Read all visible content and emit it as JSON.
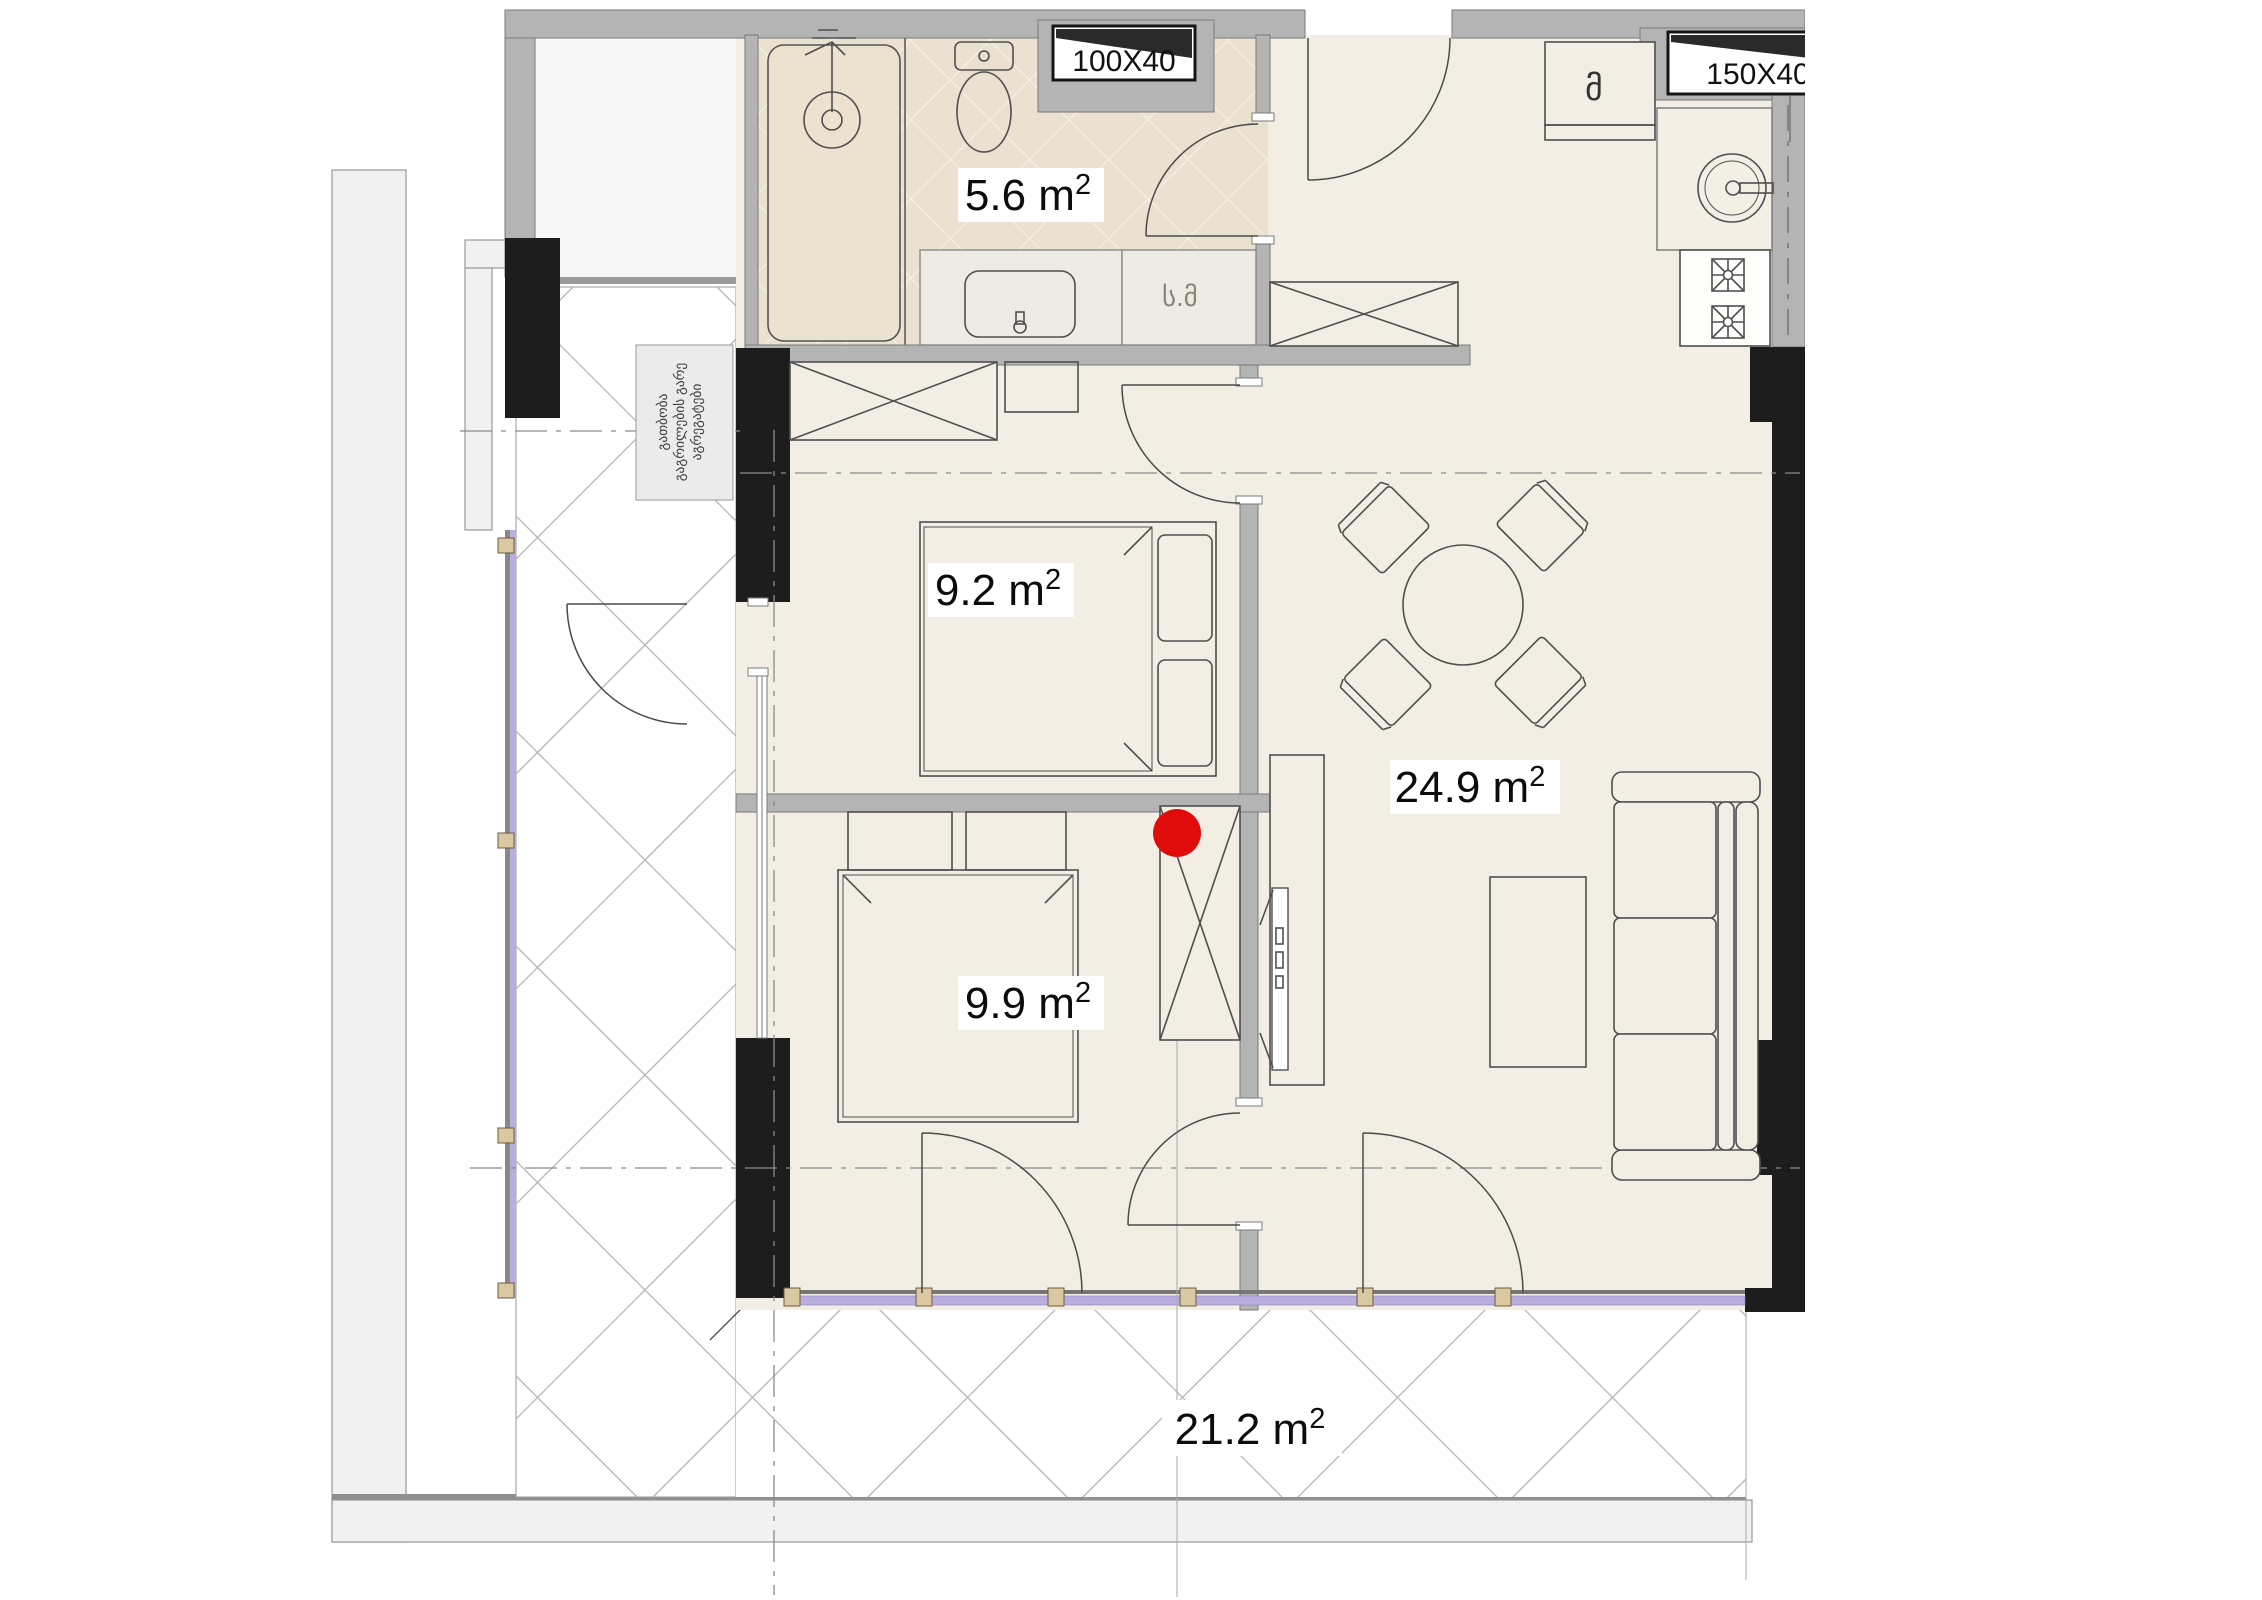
{
  "plan": {
    "rooms": {
      "bathroom": {
        "area": "5.6 m",
        "sup": "2"
      },
      "bedroom_top": {
        "area": "9.2 m",
        "sup": "2"
      },
      "bedroom_bottom": {
        "area": "9.9 m",
        "sup": "2"
      },
      "living_kitchen": {
        "area": "24.9 m",
        "sup": "2"
      },
      "terrace": {
        "area": "21.2 m",
        "sup": "2"
      }
    },
    "vents": {
      "small": "100X40",
      "large": "150X40"
    },
    "labels": {
      "washing_machine": "ს.მ",
      "fridge": "მ"
    },
    "note": {
      "lines": [
        "გათბობა",
        "გაგრილების გარე",
        "აგრეგატები"
      ]
    },
    "colors": {
      "marker_red": "#e00c0c",
      "wall_gray": "#b4b4b4",
      "column_black": "#1d1d1d",
      "glazing_lavender": "#b9aede",
      "room_floor": "#f2eee3",
      "bath_tile": "#eae1d0"
    }
  }
}
